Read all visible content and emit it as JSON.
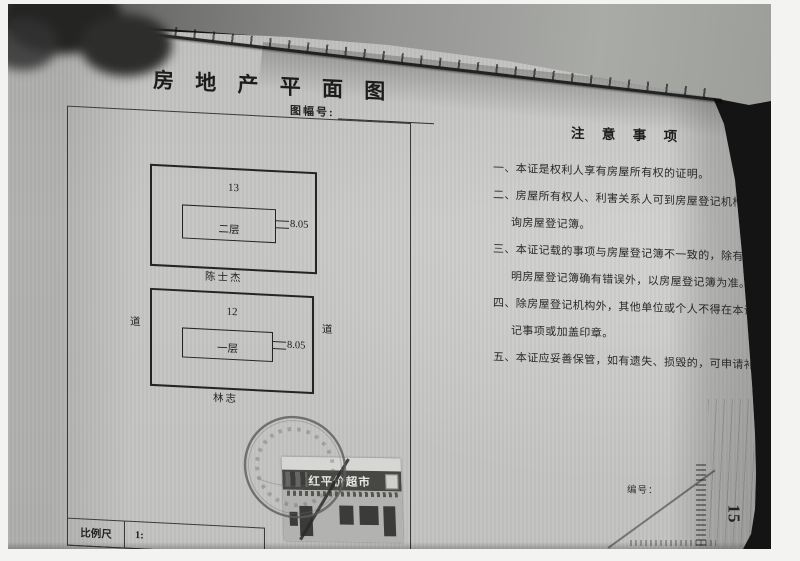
{
  "document": {
    "title": "房 地 产 平 面 图",
    "sheet_no_label": "图幅号:",
    "plan": {
      "road_left": "道",
      "road_right": "道",
      "buildings": [
        {
          "parcel_no": "13",
          "floor_label": "二层",
          "dimension": "8.05",
          "adjacent_owner": "陈士杰"
        },
        {
          "parcel_no": "12",
          "floor_label": "一层",
          "dimension": "8.05",
          "adjacent_owner": "林志"
        }
      ]
    },
    "storefront_sign": "红平价超市",
    "scale": {
      "label": "比例尺",
      "value": "1:"
    },
    "notes": {
      "heading": "注 意 事 项",
      "lines": [
        {
          "text": "一、本证是权利人享有房屋所有权的证明。",
          "indent": false
        },
        {
          "text": "二、房屋所有权人、利害关系人可到房屋登记机构依法查",
          "indent": false
        },
        {
          "text": "询房屋登记簿。",
          "indent": true
        },
        {
          "text": "三、本证记载的事项与房屋登记簿不一致的，除有证据证",
          "indent": false
        },
        {
          "text": "明房屋登记簿确有错误外，以房屋登记簿为准。",
          "indent": true
        },
        {
          "text": "四、除房屋登记机构外，其他单位或个人不得在本证上注",
          "indent": false
        },
        {
          "text": "记事项或加盖印章。",
          "indent": true
        },
        {
          "text": "五、本证应妥善保管，如有遗失、损毁的，可申请补发。",
          "indent": false
        }
      ]
    },
    "serial_label": "编号：",
    "page_number": "15"
  },
  "colors": {
    "paper": "#c2c2c0",
    "back_page": "#9b9d99",
    "ink": "#262626",
    "sign_band": "#474744",
    "gap_black": "#141414"
  }
}
